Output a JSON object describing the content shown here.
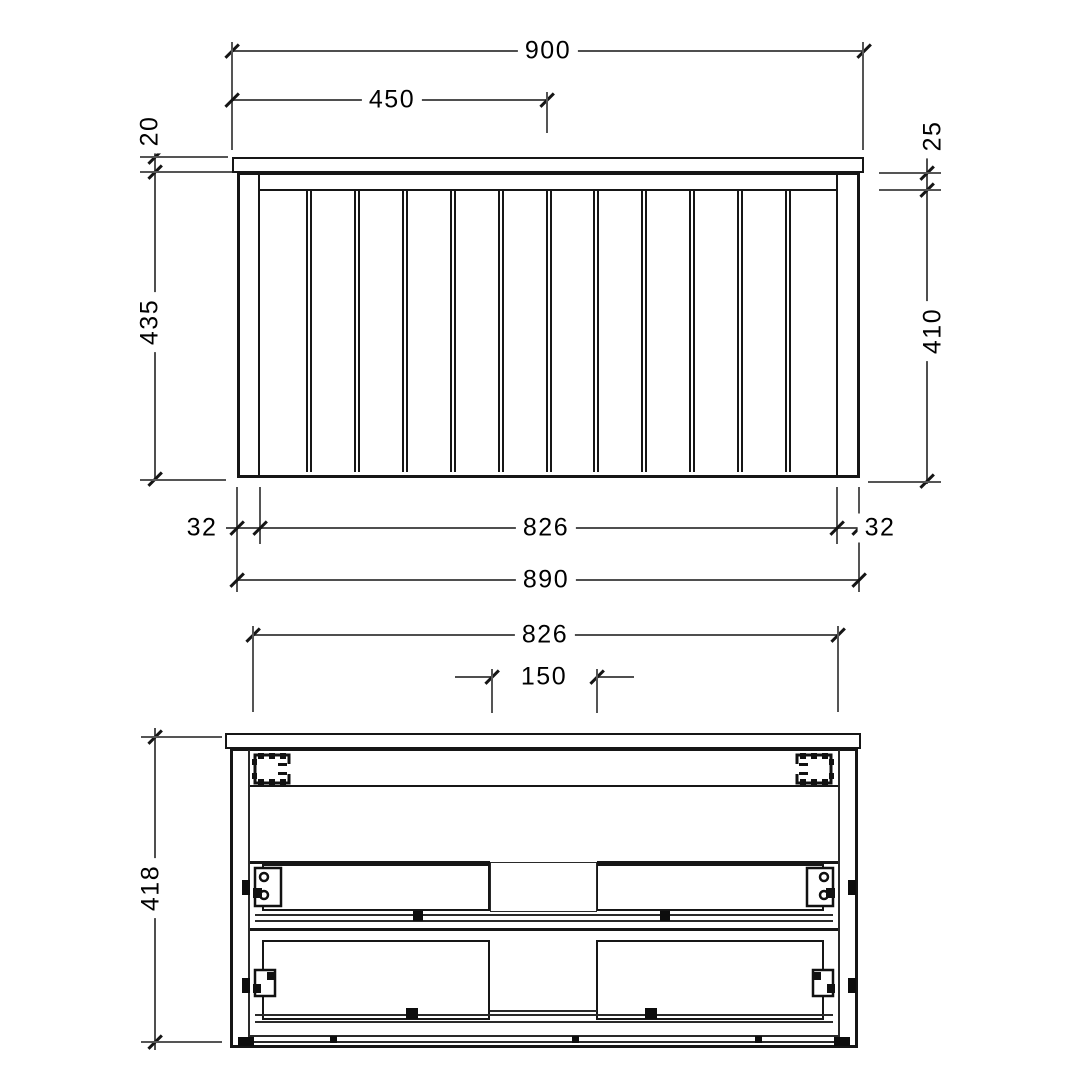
{
  "drawing_title": "vanity-cabinet-technical-drawing",
  "style": {
    "background": "#ffffff",
    "object_line_color": "#161616",
    "dimension_line_color": "#4f4f4f",
    "label_color": "#000000"
  },
  "front_view": {
    "name": "front elevation",
    "labels": {
      "overall_top_width": "900",
      "half_width": "450",
      "top_thickness": "20",
      "body_height": "435",
      "apron_height": "25",
      "slat_height": "410",
      "left_stile": "32",
      "inner_width": "826",
      "right_stile": "32",
      "body_width": "890"
    }
  },
  "plan_view": {
    "name": "sectional plan view",
    "labels": {
      "inner_width": "826",
      "center_gap": "150",
      "depth": "418"
    }
  }
}
